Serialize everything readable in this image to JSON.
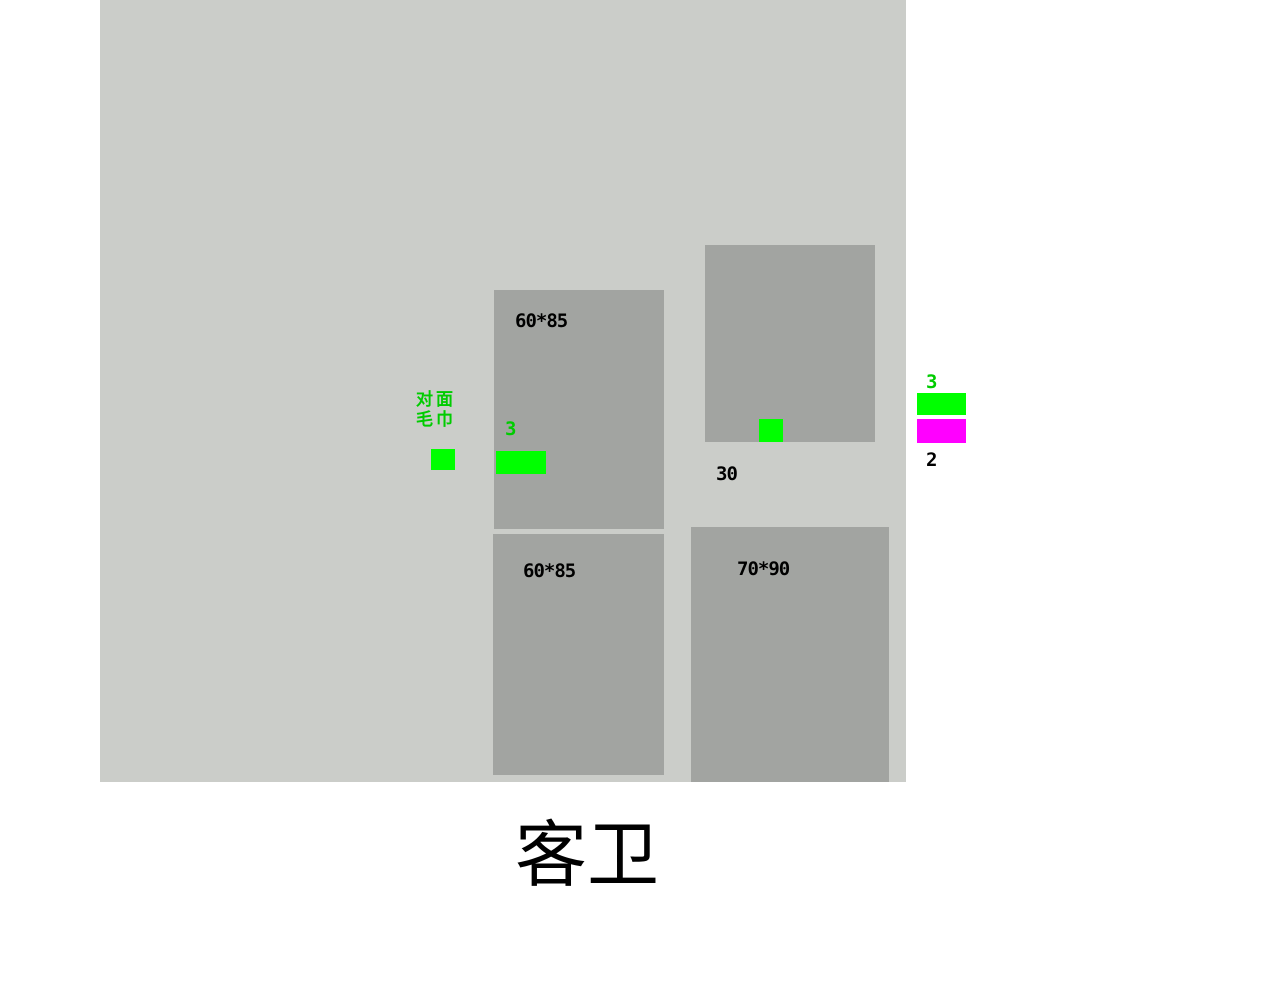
{
  "title": "客卫",
  "colors": {
    "page_bg": "#ffffff",
    "canvas_bg": "#cbcdc9",
    "box_fill": "#a2a4a1",
    "marker_green": "#00ff00",
    "marker_magenta": "#ff00ff",
    "text_green": "#00cc00",
    "text_black": "#000000"
  },
  "canvas": {
    "boxes": [
      {
        "name": "cabinet-top-left",
        "label": "60*85"
      },
      {
        "name": "cabinet-bottom-left",
        "label": "60*85"
      },
      {
        "name": "cabinet-top-right",
        "label": ""
      },
      {
        "name": "cabinet-bottom-right",
        "label": "70*90"
      }
    ],
    "note": {
      "line1": "对面",
      "line2": "毛巾"
    },
    "marker_quantity": "3",
    "dimension_label": "30"
  },
  "legend": {
    "green_quantity": "3",
    "magenta_quantity": "2"
  }
}
